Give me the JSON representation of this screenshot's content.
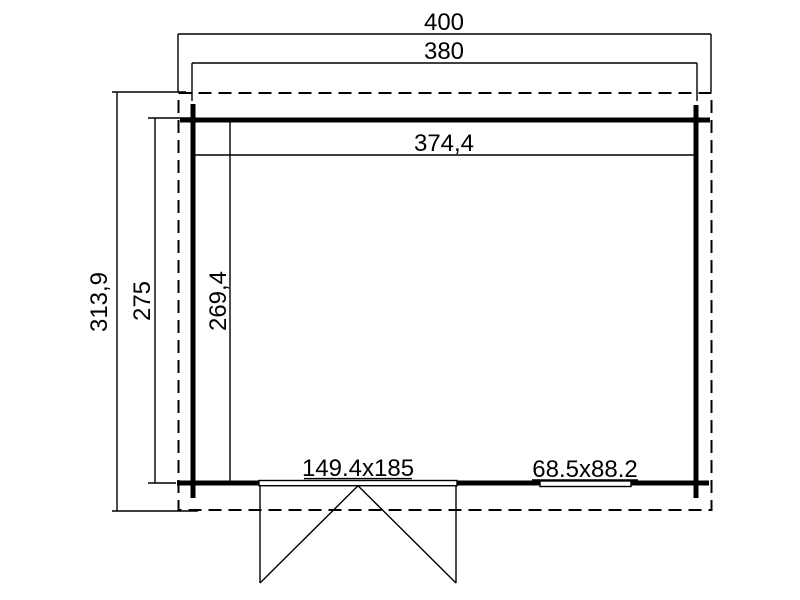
{
  "drawing": {
    "background_color": "#ffffff",
    "line_color": "#000000",
    "dimensions": {
      "overall_width": "400",
      "wall_width": "380",
      "interior_width": "374,4",
      "overall_depth": "313,9",
      "wall_depth": "275",
      "interior_depth": "269,4"
    },
    "fixtures": {
      "double_door_size": "149.4x185",
      "window_size": "68.5x88.2"
    }
  }
}
